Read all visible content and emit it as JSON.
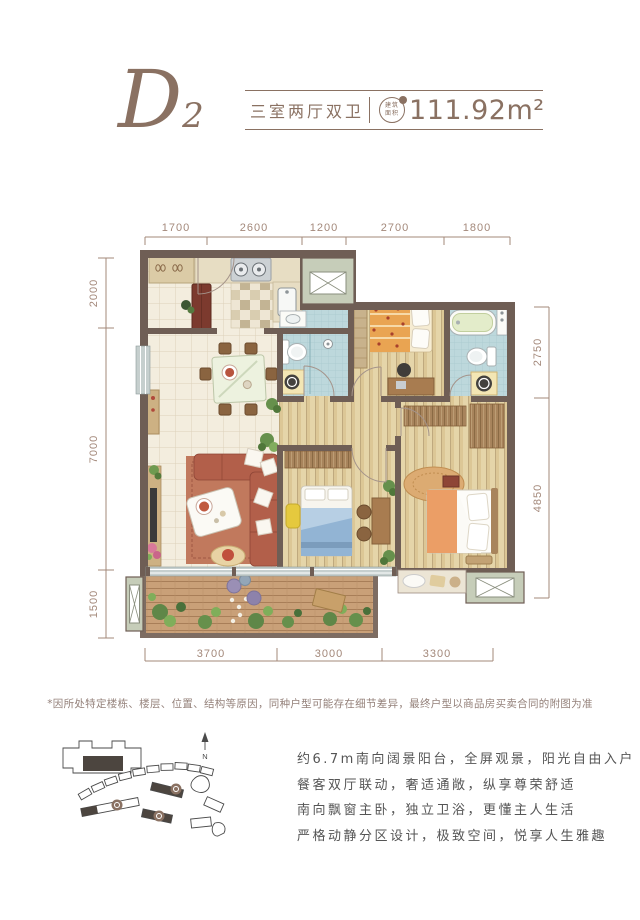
{
  "header": {
    "plan_code": "D2",
    "plan_type": "三室两厅双卫",
    "area_label": "建筑面积",
    "area_value": "111.92m²"
  },
  "dimensions": {
    "top": [
      "1700",
      "2600",
      "1200",
      "2700",
      "1800"
    ],
    "left": [
      "2000",
      "7000",
      "1500"
    ],
    "right": [
      "2750",
      "4850"
    ],
    "bottom": [
      "3700",
      "3000",
      "3300"
    ]
  },
  "disclaimer": "*因所处特定楼栋、楼层、位置、结构等原因，同种户型可能存在细节差异，最终户型以商品房买卖合同的附图为准",
  "site_plan": {
    "north_label": "N"
  },
  "description": {
    "lines": [
      "约6.7m南向阔景阳台，全屏观景，阳光自由入户",
      "餐客双厅联动，奢适通敞，纵享尊荣舒适",
      "南向飘窗主卧，独立卫浴，更懂主人生活",
      "严格动静分区设计，极致空间，悦享人生雅趣"
    ]
  },
  "colors": {
    "accent": "#8a7162",
    "dimension": "#a3887a",
    "wall": "#6f5e55",
    "bath_blue": "#bdd8dc",
    "sage": "#c6cdb9",
    "text": "#555555"
  }
}
